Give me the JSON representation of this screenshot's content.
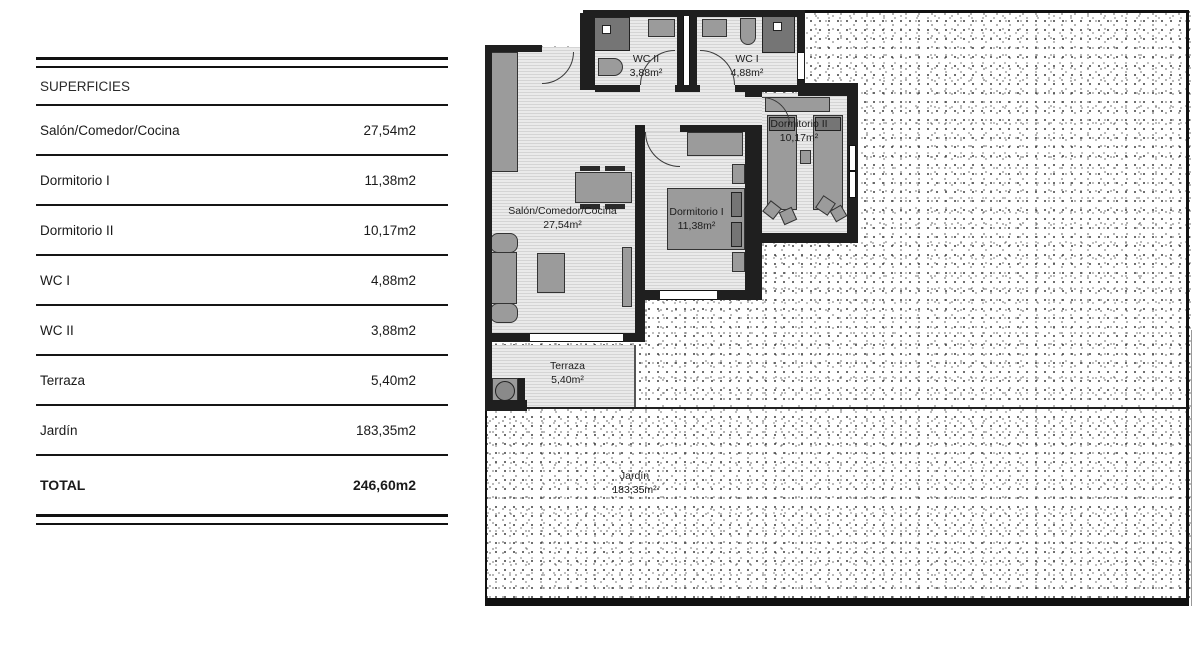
{
  "table": {
    "header": "SUPERFICIES",
    "rows": [
      {
        "label": "Salón/Comedor/Cocina",
        "value": "27,54m2"
      },
      {
        "label": "Dormitorio I",
        "value": "11,38m2"
      },
      {
        "label": "Dormitorio II",
        "value": "10,17m2"
      },
      {
        "label": "WC I",
        "value": "4,88m2"
      },
      {
        "label": "WC II",
        "value": "3,88m2"
      },
      {
        "label": "Terraza",
        "value": "5,40m2"
      },
      {
        "label": "Jardín",
        "value": "183,35m2"
      }
    ],
    "total": {
      "label": "TOTAL",
      "value": "246,60m2"
    }
  },
  "plan": {
    "rooms": [
      {
        "name": "Salón/Comedor/Cocina",
        "area": "27,54m²"
      },
      {
        "name": "Dormitorio I",
        "area": "11,38m²"
      },
      {
        "name": "Dormitorio II",
        "area": "10,17m²"
      },
      {
        "name": "WC I",
        "area": "4,88m²"
      },
      {
        "name": "WC II",
        "area": "3,88m²"
      },
      {
        "name": "Terraza",
        "area": "5,40m²"
      },
      {
        "name": "Jardín",
        "area": "183,35m²"
      }
    ]
  },
  "colors": {
    "wall": "#1f1f1f",
    "table_line": "#111111",
    "floor_fill": "#eaeaea",
    "floor_hatch": "#d4d4d4",
    "furniture": "#9b9b9b",
    "fixture_dark": "#757575",
    "text": "#1a1a1a"
  }
}
